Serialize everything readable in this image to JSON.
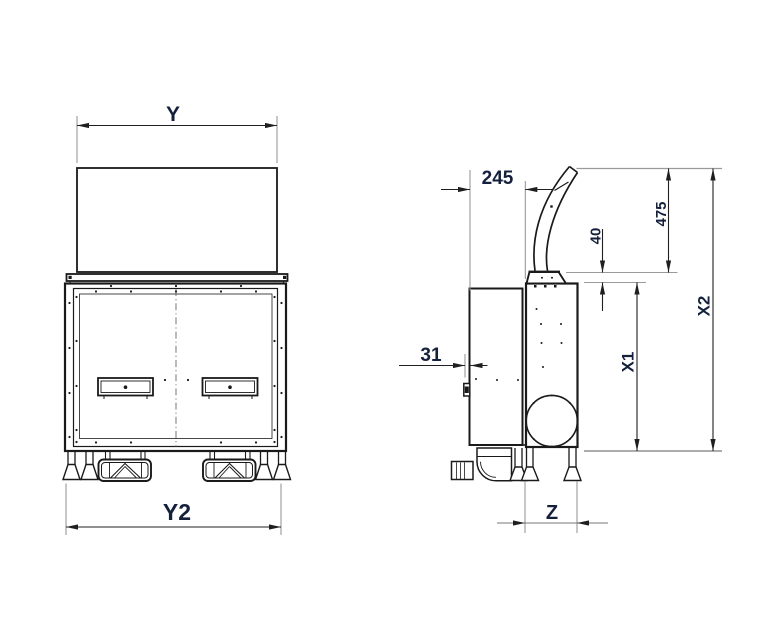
{
  "drawing": {
    "kind": "two-view technical line drawing of appliance with dimension callouts",
    "views": {
      "front": "front-view",
      "side": "side-view"
    },
    "colors": {
      "line": "#1a1a1a",
      "extension_line": "#8f8f8f",
      "dimension_line": "#1f1f1f",
      "label_text": "#14203c",
      "background": "#ffffff"
    },
    "dims": {
      "y": {
        "label": "Y"
      },
      "y2": {
        "label": "Y2"
      },
      "d245": {
        "label": "245"
      },
      "d31": {
        "label": "31"
      },
      "d40": {
        "label": "40"
      },
      "d475": {
        "label": "475"
      },
      "x1": {
        "label": "X1"
      },
      "x2": {
        "label": "X2"
      },
      "z": {
        "label": "Z"
      }
    }
  }
}
